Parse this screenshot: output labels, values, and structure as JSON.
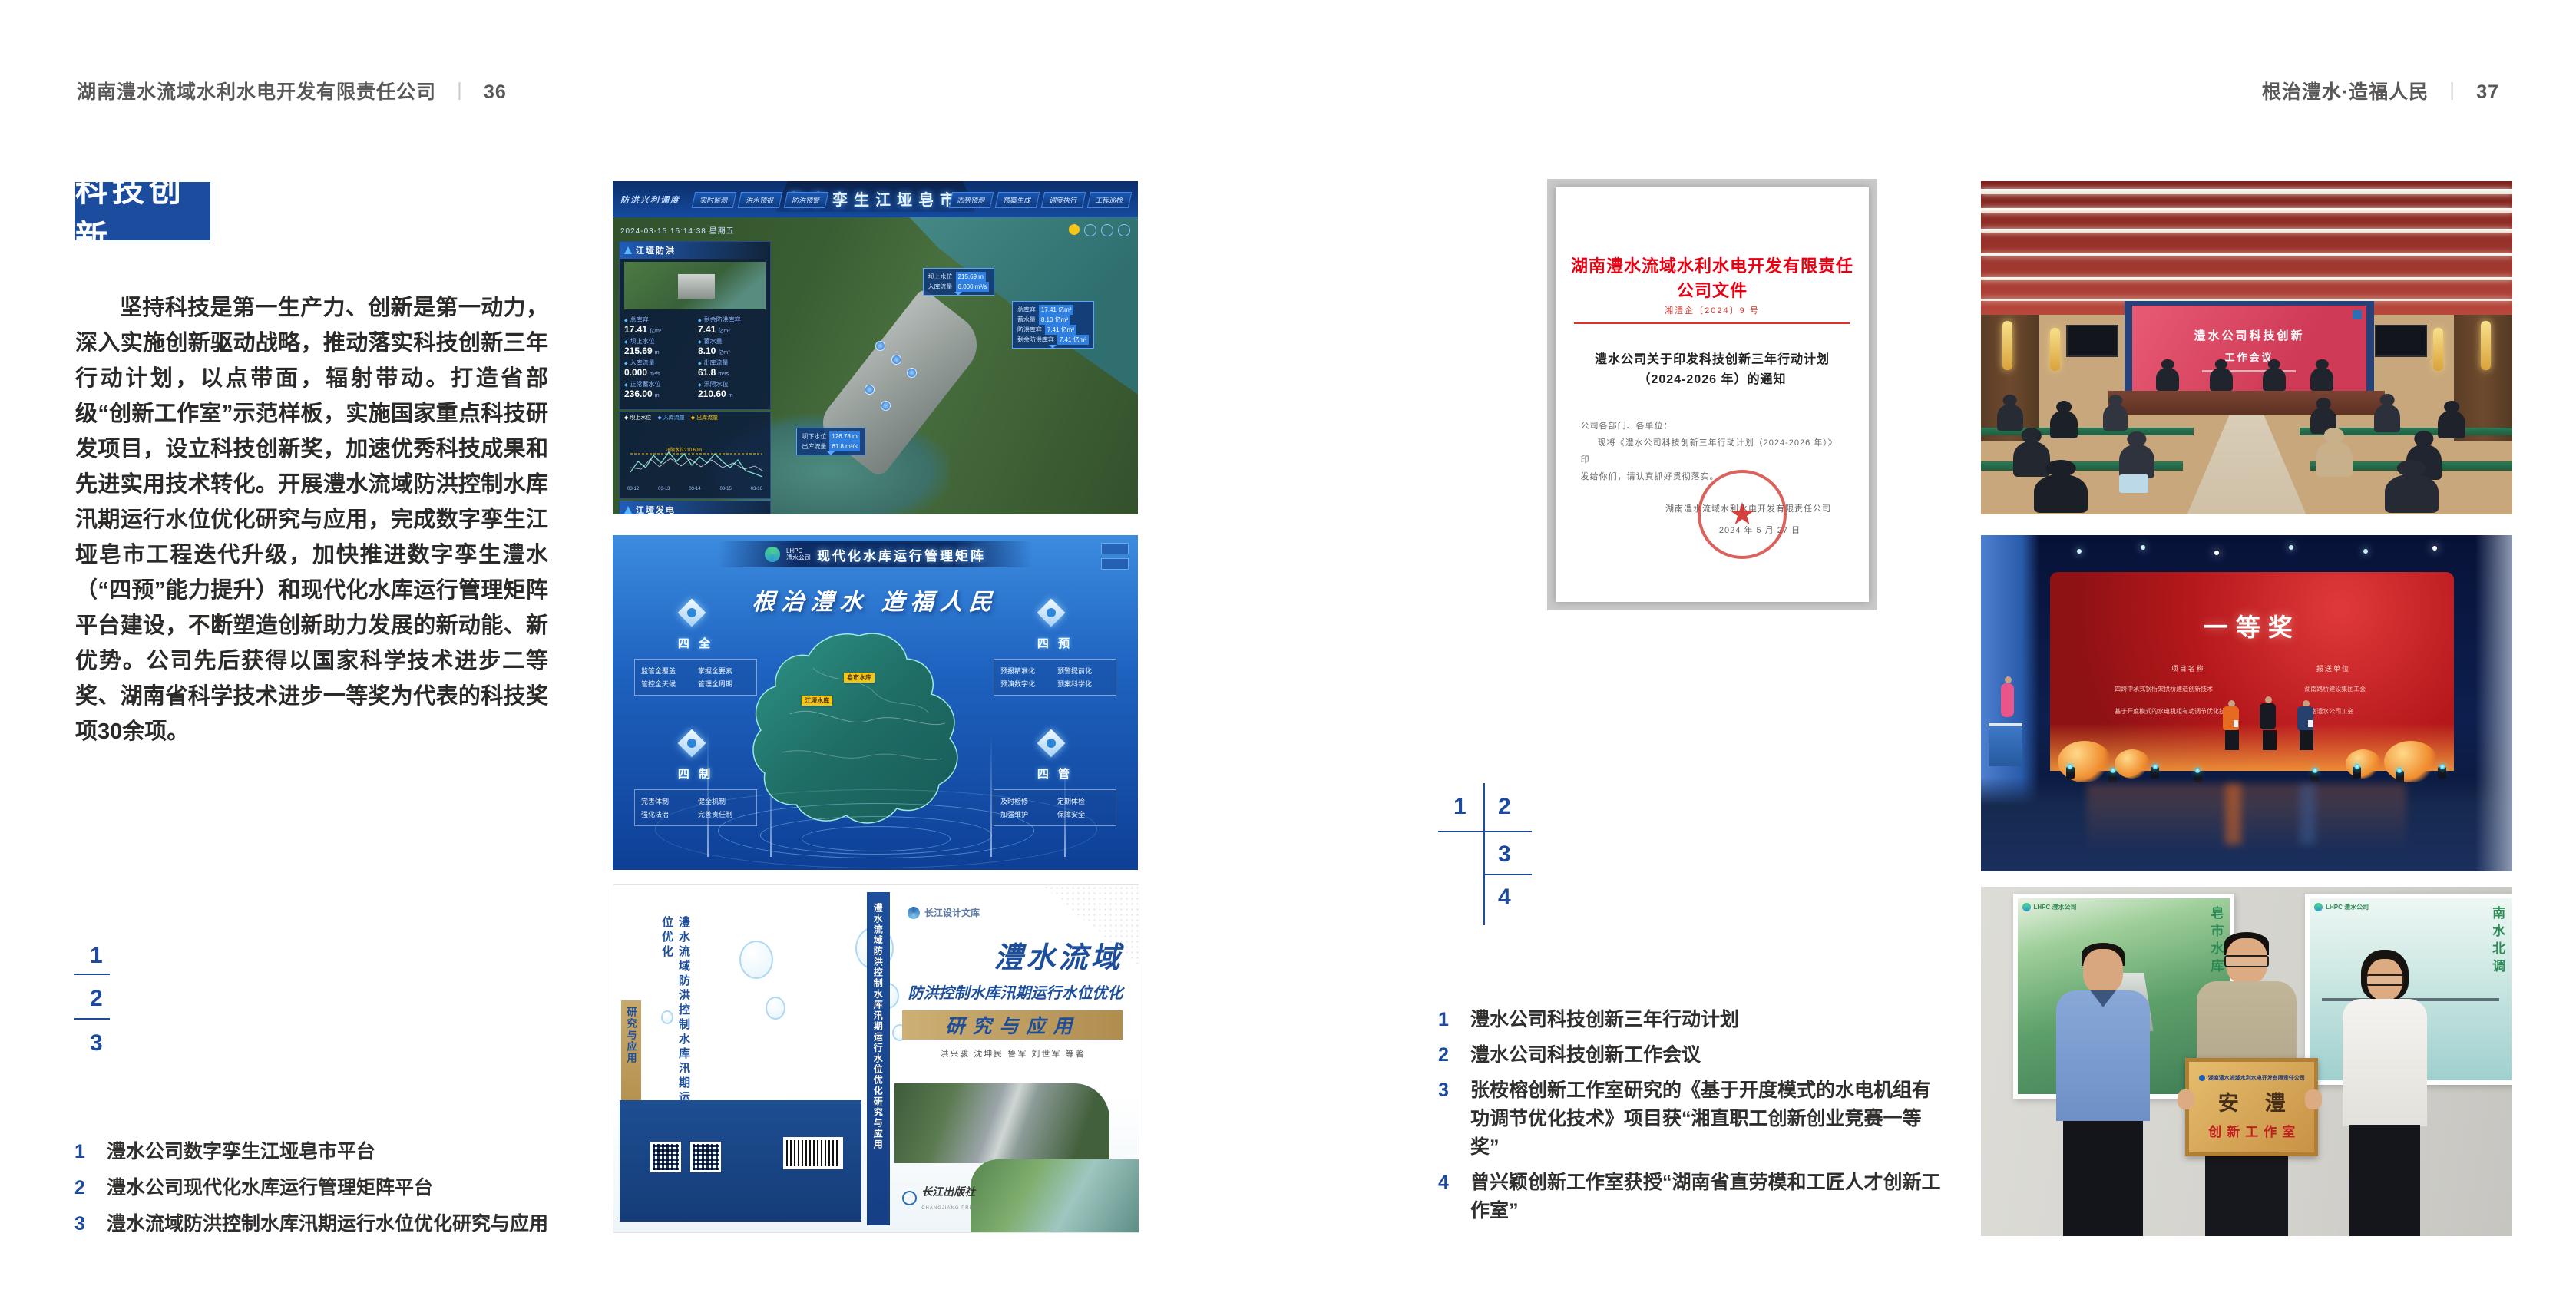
{
  "icons": {
    "seal_star": "★",
    "panel_flag": "▲"
  },
  "header": {
    "left_title": "湖南澧水流域水利水电开发有限责任公司",
    "sep": "丨",
    "left_page": "36",
    "right_title": "根治澧水·造福人民",
    "right_page": "37"
  },
  "left": {
    "badge": "科技创新",
    "paragraph": "坚持科技是第一生产力、创新是第一动力，深入实施创新驱动战略，推动落实科技创新三年行动计划，以点带面，辐射带动。打造省部级“创新工作室”示范样板，实施国家重点科技研发项目，设立科技创新奖，加速优秀科技成果和先进实用技术转化。开展澧水流域防洪控制水库汛期运行水位优化研究与应用，完成数字孪生江垭皂市工程迭代升级，加快推进数字孪生澧水（“四预”能力提升）和现代化水库运行管理矩阵平台建设，不断塑造创新助力发展的新动能、新优势。公司先后获得以国家科学技术进步二等奖、湖南省科学技术进步一等奖为代表的科技奖项30余项。",
    "nums": [
      "1",
      "2",
      "3"
    ],
    "captions": [
      {
        "num": "1",
        "text": "澧水公司数字孪生江垭皂市平台"
      },
      {
        "num": "2",
        "text": "澧水公司现代化水库运行管理矩阵平台"
      },
      {
        "num": "3",
        "text": "澧水流域防洪控制水库汛期运行水位优化研究与应用"
      }
    ]
  },
  "right": {
    "nums": [
      "1",
      "2",
      "3",
      "4"
    ],
    "captions": [
      {
        "num": "1",
        "text": "澧水公司科技创新三年行动计划"
      },
      {
        "num": "2",
        "text": "澧水公司科技创新工作会议"
      },
      {
        "num": "3",
        "text": "张桉榕创新工作室研究的《基于开度模式的水电机组有功调节优化技术》项目获“湘直职工创新创业竞赛一等奖”"
      },
      {
        "num": "4",
        "text": "曾兴颖创新工作室获授“湖南省直劳模和工匠人才创新工作室”"
      }
    ]
  },
  "fig_dashboard": {
    "title": "数字孪生江垭皂市",
    "tag": "防洪兴利调度",
    "nav_left": [
      "实时监测",
      "洪水预报",
      "防洪预警"
    ],
    "nav_right": [
      "态势预测",
      "预案生成",
      "调度执行",
      "工程巡检"
    ],
    "timestamp": "2024-03-15 15:14:38 星期五",
    "flood_title": "江垭防洪",
    "flood_stats": [
      {
        "l": "总库容",
        "v": "17.41",
        "u": "亿m³"
      },
      {
        "l": "剩余防洪库容",
        "v": "7.41",
        "u": "亿m³"
      },
      {
        "l": "坝上水位",
        "v": "215.69",
        "u": "m"
      },
      {
        "l": "蓄水量",
        "v": "8.10",
        "u": "亿m³"
      },
      {
        "l": "入库流量",
        "v": "0.000",
        "u": "m³/s"
      },
      {
        "l": "出库流量",
        "v": "61.8",
        "u": "m³/s"
      },
      {
        "l": "正常蓄水位",
        "v": "236.00",
        "u": "m"
      },
      {
        "l": "汛限水位",
        "v": "210.60",
        "u": "m"
      }
    ],
    "legend": [
      "坝上水位",
      "入库流量",
      "出库流量"
    ],
    "threshold": "汛限水位210.60m",
    "x_ticks": [
      "03-12",
      "03-13",
      "03-14",
      "03-15",
      "03-16"
    ],
    "power_title": "江垭发电",
    "power_stats": [
      {
        "l": "年发电计划",
        "v": "6.3000",
        "u": "亿度"
      },
      {
        "l": "年累计发电量",
        "v": "2907",
        "u": "亿度"
      },
      {
        "l": "月累计发电量",
        "v": "3259.21",
        "u": "万度"
      },
      {
        "l": "当前出力",
        "v": "0.00",
        "u": "MW"
      },
      {
        "l": "发电流量",
        "v": "0.00",
        "u": "m³/s"
      },
      {
        "l": "弃水流量",
        "v": "0.00",
        "u": "m³/s"
      }
    ],
    "unit_values": [
      "0.00",
      "100.98",
      "0.00"
    ],
    "units": [
      "1号机组",
      "2号机组",
      "3号机组"
    ],
    "tip_up": [
      {
        "l": "坝上水位",
        "v": "215.69 m"
      },
      {
        "l": "入库流量",
        "v": "0.000 m³/s"
      }
    ],
    "tip_side": [
      {
        "l": "总库容",
        "v": "17.41 亿m³"
      },
      {
        "l": "蓄水量",
        "v": "8.10 亿m³"
      },
      {
        "l": "防洪库容",
        "v": "7.41 亿m³"
      },
      {
        "l": "剩余防洪库容",
        "v": "7.41 亿m³"
      }
    ],
    "tip_down": [
      {
        "l": "坝下水位",
        "v": "126.78 m"
      },
      {
        "l": "出库流量",
        "v": "61.8 m³/s"
      }
    ]
  },
  "fig_matrix": {
    "brand_en": "LHPC",
    "brand_cn": "澧水公司",
    "title": "现代化水库运行管理矩阵",
    "slogan": "根治澧水  造福人民",
    "corners": [
      {
        "title": "四 全",
        "items": [
          "监管全覆盖",
          "掌握全要素",
          "管控全天候",
          "管理全周期"
        ]
      },
      {
        "title": "四 预",
        "items": [
          "预报精准化",
          "预警提前化",
          "预演数字化",
          "预案科学化"
        ]
      },
      {
        "title": "四 制",
        "items": [
          "完善体制",
          "健全机制",
          "强化法治",
          "完善责任制"
        ]
      },
      {
        "title": "四 管",
        "items": [
          "及时检修",
          "定期体检",
          "加强维护",
          "保障安全"
        ]
      }
    ],
    "map_labels": [
      "皂市水库",
      "江垭水库"
    ]
  },
  "fig_book": {
    "series": "长江设计文库",
    "title_top": "澧水流域",
    "title_mid": "防洪控制水库汛期运行水位优化",
    "band": "研究与应用",
    "authors": "洪兴骏  沈坤民  鲁军  刘世军  等著",
    "back_vertical": "澧水流域防洪控制水库汛期运行水位优化",
    "back_band": "研究与应用",
    "spine_title": "澧水流域防洪控制水库汛期运行水位优化研究与应用",
    "publisher": "长江出版社",
    "publisher_en": "CHANGJIANG PRESS"
  },
  "fig_document": {
    "header": "湖南澧水流域水利水电开发有限责任公司文件",
    "number": "湘澧企〔2024〕9 号",
    "title1": "澧水公司关于印发科技创新三年行动计划",
    "title2": "（2024-2026 年）的通知",
    "salutation": "公司各部门、各单位：",
    "body1": "现将《澧水公司科技创新三年行动计划（2024-2026 年）》印",
    "body2": "发给你们，请认真抓好贯彻落实。",
    "signer": "湖南澧水流域水利水电开发有限责任公司",
    "date": "2024 年 5 月 27 日"
  },
  "photo_meeting": {
    "screen1": "澧水公司科技创新",
    "screen2": "工作会议"
  },
  "photo_award": {
    "title": "一等奖",
    "col_project": "项目名称",
    "col_org": "报送单位",
    "rows": [
      {
        "project": "四跨中承式钢桁架拱桥建造创新技术",
        "org": "湖南路桥建设集团工会"
      },
      {
        "project": "基于开度模式的水电机组有功调节优化技术",
        "org": "湖南澧水公司工会"
      }
    ]
  },
  "photo_plaque": {
    "org": "湖南澧水流域水利水电开发有限责任公司",
    "main": "安澧",
    "sub": "创新工作室",
    "brand": "LHPC 澧水公司",
    "left_calligraphy": "皂市水库",
    "right_calligraphy": "南水北调"
  }
}
